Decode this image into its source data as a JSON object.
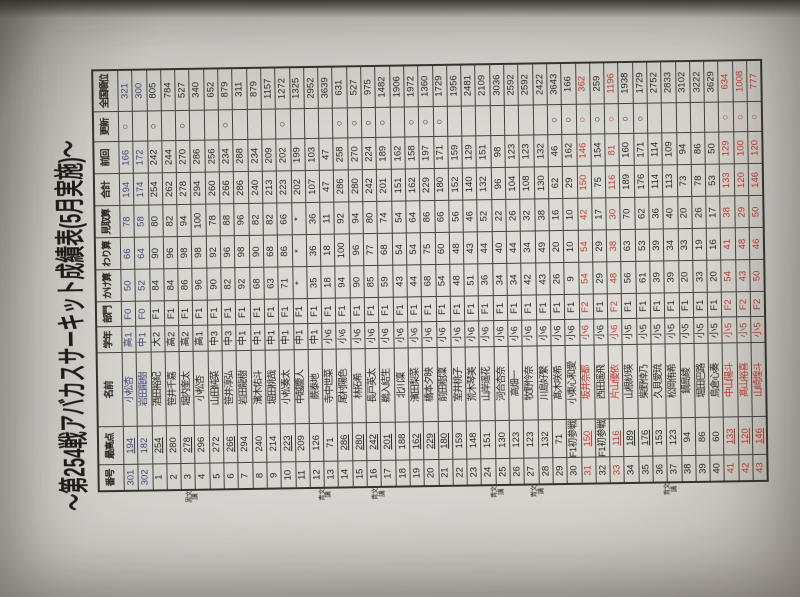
{
  "title": "～第254戦アバカスサーキット成績表(5月実施)～",
  "colors": {
    "ink": "#26241f",
    "red": "#bf3a31",
    "blue": "#3f4577",
    "paper": "#d8d6d1"
  },
  "table": {
    "headers": [
      "番号",
      "最高点",
      "名前",
      "学年",
      "部門",
      "かけ算",
      "わり算",
      "見取算",
      "合計",
      "前回",
      "更新",
      "全国順位"
    ],
    "rows": [
      {
        "no": "301",
        "best": "194",
        "name": "小松杏",
        "grade": "高1",
        "league": "F0",
        "kake": "50",
        "wari": "66",
        "mitori": "78",
        "total": "194",
        "prev": "166",
        "update": "○",
        "rank": "321",
        "color": "blue",
        "u": true
      },
      {
        "no": "302",
        "best": "182",
        "name": "岩田龍樹",
        "grade": "中1",
        "league": "F0",
        "kake": "52",
        "wari": "64",
        "mitori": "58",
        "total": "174",
        "prev": "172",
        "update": "",
        "rank": "300",
        "color": "blue",
        "u": false
      },
      {
        "no": "1",
        "best": "254",
        "name": "酒田裕紀",
        "grade": "大2",
        "league": "F1",
        "kake": "84",
        "wari": "90",
        "mitori": "80",
        "total": "254",
        "prev": "242",
        "update": "○",
        "rank": "805",
        "color": "",
        "u": true
      },
      {
        "no": "2",
        "best": "280",
        "name": "笹井千嘉",
        "grade": "高2",
        "league": "F1",
        "kake": "84",
        "wari": "96",
        "mitori": "82",
        "total": "262",
        "prev": "244",
        "update": "",
        "rank": "784",
        "color": "",
        "u": false
      },
      {
        "no": "3",
        "best": "278",
        "name": "堀内奎太",
        "grade": "高2",
        "league": "F1",
        "kake": "86",
        "wari": "98",
        "mitori": "94",
        "total": "278",
        "prev": "270",
        "update": "○",
        "rank": "527",
        "color": "",
        "u": true
      },
      {
        "no": "4",
        "best": "296",
        "name": "小松杏",
        "grade": "高1",
        "league": "F1",
        "kake": "96",
        "wari": "98",
        "mitori": "100",
        "total": "294",
        "prev": "286",
        "update": "",
        "rank": "340",
        "color": "",
        "u": false
      },
      {
        "no": "5",
        "best": "272",
        "name": "山田純菜",
        "grade": "中3",
        "league": "F1",
        "kake": "90",
        "wari": "92",
        "mitori": "78",
        "total": "260",
        "prev": "256",
        "update": "",
        "rank": "652",
        "color": "",
        "u": false
      },
      {
        "no": "6",
        "best": "266",
        "name": "笹井淳弘",
        "grade": "中3",
        "league": "F1",
        "kake": "82",
        "wari": "96",
        "mitori": "88",
        "total": "266",
        "prev": "234",
        "update": "○",
        "rank": "879",
        "color": "",
        "u": true
      },
      {
        "no": "7",
        "best": "294",
        "name": "岩田龍樹",
        "grade": "中1",
        "league": "F1",
        "kake": "92",
        "wari": "98",
        "mitori": "96",
        "total": "286",
        "prev": "288",
        "update": "",
        "rank": "311",
        "color": "",
        "u": false
      },
      {
        "no": "8",
        "best": "240",
        "name": "濱木佑斗",
        "grade": "中1",
        "league": "F1",
        "kake": "68",
        "wari": "90",
        "mitori": "82",
        "total": "240",
        "prev": "234",
        "update": "",
        "rank": "879",
        "color": "",
        "u": false
      },
      {
        "no": "9",
        "best": "214",
        "name": "堀田桃哉",
        "grade": "中1",
        "league": "F1",
        "kake": "63",
        "wari": "68",
        "mitori": "82",
        "total": "213",
        "prev": "209",
        "update": "",
        "rank": "1157",
        "color": "",
        "u": false
      },
      {
        "no": "10",
        "best": "223",
        "name": "小松奏太",
        "grade": "中1",
        "league": "F1",
        "kake": "71",
        "wari": "86",
        "mitori": "66",
        "total": "223",
        "prev": "202",
        "update": "○",
        "rank": "1272",
        "color": "",
        "u": true
      },
      {
        "no": "11",
        "best": "209",
        "name": "中越慶人",
        "grade": "中1",
        "league": "F1",
        "kake": "*",
        "wari": "*",
        "mitori": "*",
        "total": "202",
        "prev": "199",
        "update": "",
        "rank": "1325",
        "color": "",
        "u": false
      },
      {
        "no": "12",
        "best": "126",
        "name": "蕨泰地",
        "grade": "中1",
        "league": "F1",
        "kake": "35",
        "wari": "36",
        "mitori": "36",
        "total": "107",
        "prev": "103",
        "update": "",
        "rank": "2952",
        "color": "",
        "u": false
      },
      {
        "no": "13",
        "best": "71",
        "name": "寺中世菜",
        "grade": "小6",
        "league": "F1",
        "kake": "18",
        "wari": "18",
        "mitori": "11",
        "total": "47",
        "prev": "47",
        "update": "",
        "rank": "3639",
        "color": "",
        "u": false
      },
      {
        "no": "14",
        "best": "286",
        "name": "尾村陽色",
        "grade": "小6",
        "league": "F1",
        "kake": "94",
        "wari": "100",
        "mitori": "92",
        "total": "286",
        "prev": "258",
        "update": "○",
        "rank": "631",
        "color": "",
        "u": true
      },
      {
        "no": "15",
        "best": "280",
        "name": "林拓希",
        "grade": "小6",
        "league": "F1",
        "kake": "90",
        "wari": "96",
        "mitori": "94",
        "total": "280",
        "prev": "270",
        "update": "○",
        "rank": "527",
        "color": "",
        "u": true
      },
      {
        "no": "16",
        "best": "242",
        "name": "長戸英太",
        "grade": "小6",
        "league": "F1",
        "kake": "85",
        "wari": "77",
        "mitori": "80",
        "total": "242",
        "prev": "224",
        "update": "○",
        "rank": "975",
        "color": "",
        "u": true
      },
      {
        "no": "17",
        "best": "201",
        "name": "鵜入結生",
        "grade": "小6",
        "league": "F1",
        "kake": "59",
        "wari": "68",
        "mitori": "74",
        "total": "201",
        "prev": "189",
        "update": "○",
        "rank": "1482",
        "color": "",
        "u": true
      },
      {
        "no": "18",
        "best": "188",
        "name": "北川凜",
        "grade": "小6",
        "league": "F1",
        "kake": "43",
        "wari": "54",
        "mitori": "54",
        "total": "151",
        "prev": "162",
        "update": "",
        "rank": "1906",
        "color": "",
        "u": false
      },
      {
        "no": "19",
        "best": "162",
        "name": "濱田梨菜",
        "grade": "小6",
        "league": "F1",
        "kake": "44",
        "wari": "54",
        "mitori": "64",
        "total": "162",
        "prev": "158",
        "update": "○",
        "rank": "1972",
        "color": "",
        "u": true
      },
      {
        "no": "20",
        "best": "229",
        "name": "橋本夕映",
        "grade": "小6",
        "league": "F1",
        "kake": "68",
        "wari": "75",
        "mitori": "86",
        "total": "229",
        "prev": "197",
        "update": "○",
        "rank": "1360",
        "color": "",
        "u": true
      },
      {
        "no": "21",
        "best": "180",
        "name": "前田樹凜",
        "grade": "小6",
        "league": "F1",
        "kake": "54",
        "wari": "60",
        "mitori": "66",
        "total": "180",
        "prev": "171",
        "update": "○",
        "rank": "1729",
        "color": "",
        "u": true
      },
      {
        "no": "22",
        "best": "159",
        "name": "室井桃子",
        "grade": "小6",
        "league": "F1",
        "kake": "48",
        "wari": "48",
        "mitori": "56",
        "total": "152",
        "prev": "159",
        "update": "",
        "rank": "1956",
        "color": "",
        "u": false
      },
      {
        "no": "23",
        "best": "148",
        "name": "荒木琴美",
        "grade": "小6",
        "league": "F1",
        "kake": "51",
        "wari": "43",
        "mitori": "46",
        "total": "140",
        "prev": "129",
        "update": "",
        "rank": "2481",
        "color": "",
        "u": false
      },
      {
        "no": "24",
        "best": "151",
        "name": "山岸遥花",
        "grade": "小6",
        "league": "F1",
        "kake": "36",
        "wari": "44",
        "mitori": "52",
        "total": "132",
        "prev": "151",
        "update": "",
        "rank": "2109",
        "color": "",
        "u": false
      },
      {
        "no": "25",
        "best": "130",
        "name": "河合杏奈",
        "grade": "小6",
        "league": "F1",
        "kake": "34",
        "wari": "40",
        "mitori": "22",
        "total": "96",
        "prev": "98",
        "update": "",
        "rank": "3036",
        "color": "",
        "u": false
      },
      {
        "no": "26",
        "best": "123",
        "name": "高畑一",
        "grade": "小6",
        "league": "F1",
        "kake": "34",
        "wari": "44",
        "mitori": "26",
        "total": "104",
        "prev": "123",
        "update": "",
        "rank": "2592",
        "color": "",
        "u": false
      },
      {
        "no": "27",
        "best": "123",
        "name": "牧野怜奈",
        "grade": "小6",
        "league": "F1",
        "kake": "42",
        "wari": "34",
        "mitori": "32",
        "total": "108",
        "prev": "123",
        "update": "",
        "rank": "2592",
        "color": "",
        "u": false
      },
      {
        "no": "28",
        "best": "132",
        "name": "川島好繫",
        "grade": "小6",
        "league": "F1",
        "kake": "43",
        "wari": "49",
        "mitori": "38",
        "total": "130",
        "prev": "132",
        "update": "",
        "rank": "2422",
        "color": "",
        "u": false
      },
      {
        "no": "29",
        "best": "71",
        "name": "髙木咲希",
        "grade": "小6",
        "league": "F1",
        "kake": "26",
        "wari": "20",
        "mitori": "16",
        "total": "62",
        "prev": "46",
        "update": "○",
        "rank": "3643",
        "color": "",
        "u": false
      },
      {
        "no": "30",
        "best": "F1初参戦",
        "name": "小東心和愛",
        "grade": "小6",
        "league": "F1",
        "kake": "9",
        "wari": "10",
        "mitori": "10",
        "total": "29",
        "prev": "162",
        "update": "○",
        "rank": "166",
        "color": "",
        "u": false
      },
      {
        "no": "31",
        "best": "150",
        "name": "坂井奈都",
        "grade": "小6",
        "league": "F2",
        "kake": "54",
        "wari": "54",
        "mitori": "42",
        "total": "150",
        "prev": "146",
        "update": "○",
        "rank": "362",
        "color": "red",
        "u": true
      },
      {
        "no": "32",
        "best": "F1初参戦",
        "name": "西田遥飛",
        "grade": "小6",
        "league": "F1",
        "kake": "29",
        "wari": "29",
        "mitori": "17",
        "total": "75",
        "prev": "154",
        "update": "○",
        "rank": "259",
        "color": "",
        "u": false
      },
      {
        "no": "33",
        "best": "116",
        "name": "片山優依",
        "grade": "小6",
        "league": "F2",
        "kake": "48",
        "wari": "38",
        "mitori": "30",
        "total": "116",
        "prev": "81",
        "update": "○",
        "rank": "1196",
        "color": "red",
        "u": true
      },
      {
        "no": "34",
        "best": "189",
        "name": "山根紗瑛",
        "grade": "小5",
        "league": "F1",
        "kake": "56",
        "wari": "63",
        "mitori": "70",
        "total": "189",
        "prev": "160",
        "update": "○",
        "rank": "1938",
        "color": "",
        "u": true
      },
      {
        "no": "35",
        "best": "176",
        "name": "柴野倖乃",
        "grade": "小5",
        "league": "F1",
        "kake": "61",
        "wari": "53",
        "mitori": "62",
        "total": "176",
        "prev": "171",
        "update": "○",
        "rank": "1729",
        "color": "",
        "u": true
      },
      {
        "no": "36",
        "best": "153",
        "name": "久貝愛琉",
        "grade": "小5",
        "league": "F1",
        "kake": "39",
        "wari": "39",
        "mitori": "36",
        "total": "114",
        "prev": "114",
        "update": "",
        "rank": "2752",
        "color": "",
        "u": false
      },
      {
        "no": "37",
        "best": "123",
        "name": "松岡侑希",
        "grade": "小5",
        "league": "F1",
        "kake": "39",
        "wari": "34",
        "mitori": "40",
        "total": "113",
        "prev": "109",
        "update": "",
        "rank": "2833",
        "color": "",
        "u": false
      },
      {
        "no": "38",
        "best": "94",
        "name": "鍋島綾",
        "grade": "小5",
        "league": "F1",
        "kake": "20",
        "wari": "33",
        "mitori": "20",
        "total": "73",
        "prev": "94",
        "update": "",
        "rank": "3102",
        "color": "",
        "u": false
      },
      {
        "no": "39",
        "best": "86",
        "name": "堀田巴路",
        "grade": "小5",
        "league": "F1",
        "kake": "33",
        "wari": "19",
        "mitori": "26",
        "total": "78",
        "prev": "86",
        "update": "",
        "rank": "3222",
        "color": "",
        "u": false
      },
      {
        "no": "40",
        "best": "60",
        "name": "鳥倉心奏",
        "grade": "小5",
        "league": "F1",
        "kake": "20",
        "wari": "16",
        "mitori": "17",
        "total": "53",
        "prev": "50",
        "update": "",
        "rank": "3629",
        "color": "",
        "u": false
      },
      {
        "no": "41",
        "best": "133",
        "name": "中山陽斗",
        "grade": "小5",
        "league": "F2",
        "kake": "54",
        "wari": "41",
        "mitori": "38",
        "total": "133",
        "prev": "129",
        "update": "○",
        "rank": "634",
        "color": "red",
        "u": true
      },
      {
        "no": "42",
        "best": "120",
        "name": "髙山裕喜",
        "grade": "小5",
        "league": "F2",
        "kake": "43",
        "wari": "48",
        "mitori": "29",
        "total": "120",
        "prev": "100",
        "update": "○",
        "rank": "1008",
        "color": "red",
        "u": true
      },
      {
        "no": "43",
        "best": "146",
        "name": "山崎煌斗",
        "grade": "小5",
        "league": "F2",
        "kake": "50",
        "wari": "46",
        "mitori": "50",
        "total": "146",
        "prev": "120",
        "update": "○",
        "rank": "777",
        "color": "red",
        "u": true
      }
    ]
  },
  "margin_notes": [
    {
      "text": "黒文講",
      "row_index": 5
    },
    {
      "text": "青文講",
      "row_index": 15
    },
    {
      "text": "青文講",
      "row_index": 19
    },
    {
      "text": "青文講",
      "row_index": 28
    },
    {
      "text": "青文講",
      "row_index": 31
    },
    {
      "text": "青文講",
      "row_index": 41
    }
  ]
}
